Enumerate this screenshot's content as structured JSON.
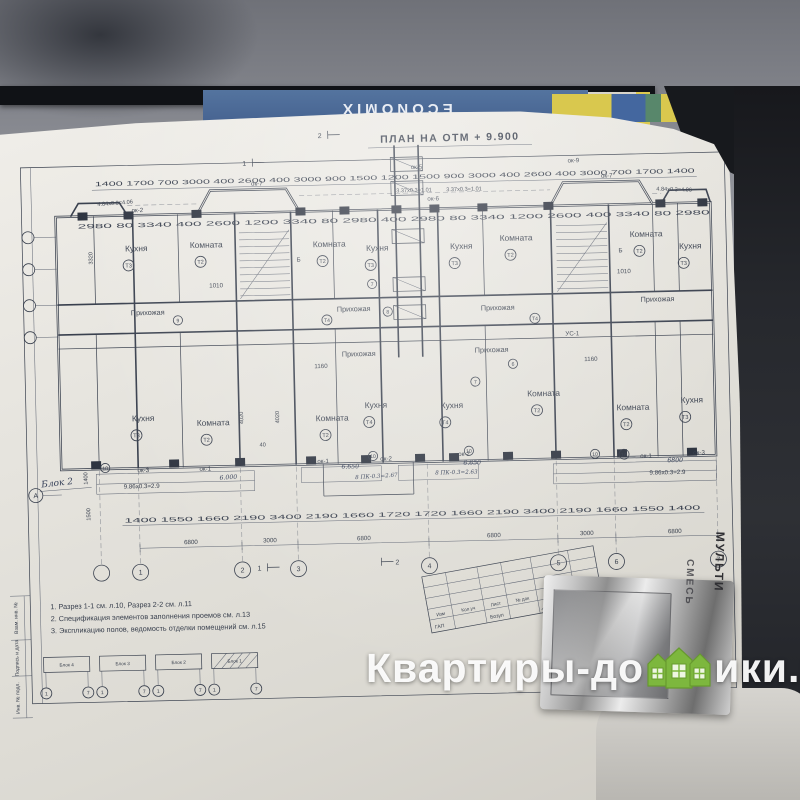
{
  "photo": {
    "book_label": "ECONOMIX",
    "watermark": {
      "left": "Квартиры-до",
      "right": "ики.рф",
      "houses_color": "#7db73e"
    },
    "foil": {
      "line1": "МУЛЬТИ",
      "line2": "СМЕСЬ"
    }
  },
  "plan": {
    "title": "ПЛАН НА ОТМ + 9.900",
    "dims": {
      "top_chain": "1400 1700 700 3000 400 2600 400 3000 900 1500 1200 1500 900 3000 400 2600 400 3000 700 1700 1400",
      "wall_chain": "2980 80 3340 400 2600 1200 3340 80 2980 400 2980 80 3340 1200 2600 400 3340 80 2980",
      "bottom_chain": "1400 1550 1660 2190 3400 2190 1660 1720 1720 1660 2190 3400 2190 1660 1550 1400",
      "spans": [
        "6800",
        "3000",
        "6800",
        "6800",
        "3000",
        "6800"
      ],
      "v1": "4020",
      "v2": "3320",
      "v3": "1400",
      "v4": "1500",
      "d1010": "1010",
      "d1160": "1160",
      "d40": "40"
    },
    "axes_bottom": [
      "1",
      "2",
      "3",
      "4",
      "5",
      "6",
      "7"
    ],
    "axis_left": "А",
    "axis_b": "Б",
    "rooms_top": [
      {
        "label": "Кухня",
        "tag": "Т3"
      },
      {
        "label": "Комната",
        "tag": "Т2"
      },
      {
        "label": "Комната",
        "tag": "Т2"
      },
      {
        "label": "Кухня",
        "tag": "Т3"
      },
      {
        "label": "Кухня",
        "tag": "Т3"
      },
      {
        "label": "Комната",
        "tag": "Т2"
      },
      {
        "label": "Комната",
        "tag": "Т2"
      },
      {
        "label": "Кухня",
        "tag": "Т3"
      }
    ],
    "rooms_bottom": [
      {
        "label": "Кухня",
        "tag": "Т3"
      },
      {
        "label": "Комната",
        "tag": "Т2"
      },
      {
        "label": "Комната",
        "tag": "Т2"
      },
      {
        "label": "Кухня",
        "tag": "Т4"
      },
      {
        "label": "Кухня",
        "tag": "Т4"
      },
      {
        "label": "Комната",
        "tag": "Т2"
      },
      {
        "label": "Комната",
        "tag": "Т2"
      },
      {
        "label": "Кухня",
        "tag": "Т3"
      }
    ],
    "hall": "Прихожая",
    "hall_tag": "Т4",
    "windows_top": [
      "ок-2",
      "ок-7",
      "ок-5",
      "ок-6",
      "ок-9",
      "ок-7"
    ],
    "windows_bottom": [
      "ок-3",
      "ок-1",
      "ок-1",
      "ок-2",
      "ок-2",
      "ок-1",
      "ок-3"
    ],
    "ann": {
      "tl": "4.84х0.3=4.06",
      "tm1": "3.37х0.3=1.01",
      "tm2": "3.37х0.3=1.01",
      "tr": "4.84х0.3=4.06",
      "bl": "9.86х0.3=2.9",
      "br": "9.86х0.3=2.9",
      "h1": "6.000",
      "h2": "6.650",
      "h3": "6.650",
      "h4": "6800",
      "pk1": "8 ПК-0.3=2.67",
      "pk2": "8 ПК-0.3=2.63",
      "us": "УС-1"
    },
    "node_marks": [
      "7",
      "8",
      "6",
      "7",
      "9",
      "10",
      "10",
      "10",
      "10",
      "1А"
    ],
    "section": {
      "s1": "1",
      "s2": "2"
    },
    "block_label": "Блок 2",
    "notes": [
      "1. Разрез 1-1 см. л.10, Разрез 2-2 см. л.11",
      "2. Спецификация элементов заполнения проемов см. л.13",
      "3. Экспликацию полов, ведомость отделки помещений см. л.15"
    ],
    "key_plan": {
      "blocks": [
        "Блок 4",
        "Блок 3",
        "Блок 2",
        "Блок 1"
      ],
      "c1": "1",
      "c7": "7"
    },
    "title_block": {
      "headers": [
        "Изм",
        "Кол.уч",
        "Лист",
        "№ док",
        "Подпись",
        "Дата"
      ],
      "row": "ГАП",
      "name": "Бозул"
    },
    "side_labels": [
      "Взам. инв. №",
      "Подпись и дата",
      "Инв. № подл."
    ]
  }
}
